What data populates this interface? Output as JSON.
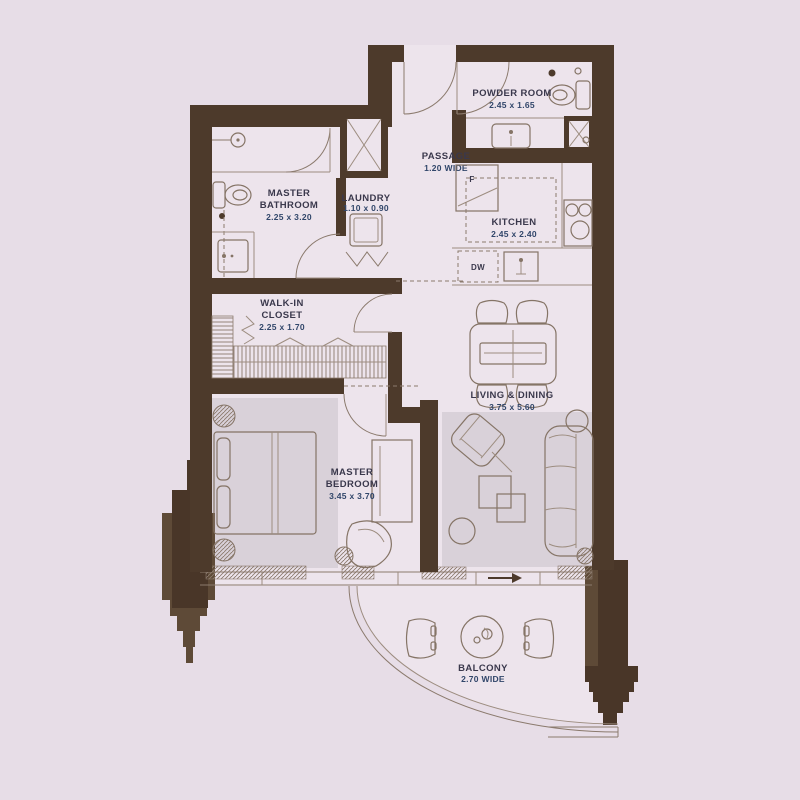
{
  "plan_title": "residential-unit-floor-plan",
  "palette": {
    "background": "#e7dde7",
    "floor": "#ede4ec",
    "wall_brown": "#4d3a2b",
    "fin_light": "#5e4a37",
    "fin_dark": "#493628",
    "rug_grey": "#d9d1d9",
    "line_brown": "#8b7a6d",
    "label_dark": "#3a384c",
    "label_blue": "#31466a"
  },
  "rooms": {
    "powder": {
      "name": "POWDER ROOM",
      "dims": "2.45 x 1.65"
    },
    "passage": {
      "name": "PASSAGE",
      "dims": "1.20 WIDE"
    },
    "master_bathroom": {
      "name1": "MASTER",
      "name2": "BATHROOM",
      "dims": "2.25 x 3.20"
    },
    "laundry": {
      "name": "LAUNDRY",
      "dims": "1.10 x 0.90"
    },
    "kitchen": {
      "name": "KITCHEN",
      "dims": "2.45 x 2.40"
    },
    "walk_in_closet": {
      "name1": "WALK-IN",
      "name2": "CLOSET",
      "dims": "2.25 x 1.70"
    },
    "living_dining": {
      "name": "LIVING & DINING",
      "dims": "3.75 x 5.60"
    },
    "master_bedroom": {
      "name1": "MASTER",
      "name2": "BEDROOM",
      "dims": "3.45 x 3.70"
    },
    "balcony": {
      "name": "BALCONY",
      "dims": "2.70 WIDE"
    }
  },
  "appliances": {
    "fridge": "F",
    "dishwasher": "DW"
  }
}
